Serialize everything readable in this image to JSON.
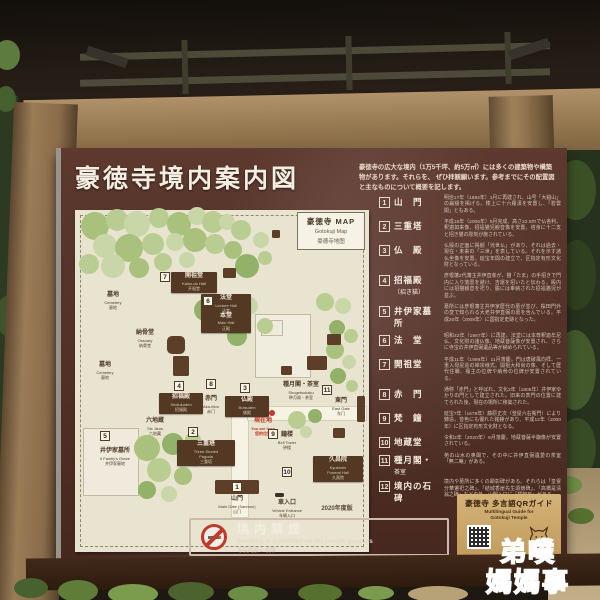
{
  "photo": {
    "watermark": {
      "line1": "弟噗",
      "line2": "媽媽事"
    }
  },
  "sign": {
    "title": "豪徳寺境内案内図",
    "intro": {
      "line1": "豪徳寺の広大な境内（1万5千坪、約5万㎡）には多くの建築物や構築物があります。それらを、",
      "line2": "ぜひ拝観願います。参考までにその配置図と主なものについて概要を記します。"
    },
    "map": {
      "corner_box": {
        "jp": "豪徳寺 MAP",
        "en": "Gotokuji Map",
        "zh": "豪德寺地图"
      },
      "tree_colors": [
        "#a9c17d",
        "#b9cd92",
        "#c8d6a8",
        "#93b168",
        "#d2dcb9"
      ],
      "trees": [
        {
          "x": 20,
          "y": 16,
          "r": 14,
          "c": 0
        },
        {
          "x": 42,
          "y": 10,
          "r": 11,
          "c": 1
        },
        {
          "x": 62,
          "y": 14,
          "r": 13,
          "c": 2
        },
        {
          "x": 84,
          "y": 8,
          "r": 10,
          "c": 1
        },
        {
          "x": 104,
          "y": 14,
          "r": 12,
          "c": 0
        },
        {
          "x": 122,
          "y": 6,
          "r": 9,
          "c": 2
        },
        {
          "x": 138,
          "y": 12,
          "r": 11,
          "c": 1
        },
        {
          "x": 30,
          "y": 36,
          "r": 12,
          "c": 2
        },
        {
          "x": 54,
          "y": 38,
          "r": 14,
          "c": 0
        },
        {
          "x": 78,
          "y": 34,
          "r": 11,
          "c": 1
        },
        {
          "x": 100,
          "y": 32,
          "r": 9,
          "c": 2
        },
        {
          "x": 120,
          "y": 30,
          "r": 12,
          "c": 0
        },
        {
          "x": 140,
          "y": 34,
          "r": 10,
          "c": 1
        },
        {
          "x": 14,
          "y": 54,
          "r": 10,
          "c": 1
        },
        {
          "x": 38,
          "y": 56,
          "r": 12,
          "c": 2
        },
        {
          "x": 64,
          "y": 58,
          "r": 10,
          "c": 0
        },
        {
          "x": 88,
          "y": 52,
          "r": 9,
          "c": 1
        },
        {
          "x": 112,
          "y": 50,
          "r": 8,
          "c": 2
        },
        {
          "x": 152,
          "y": 12,
          "r": 8,
          "c": 2
        },
        {
          "x": 166,
          "y": 20,
          "r": 10,
          "c": 1
        },
        {
          "x": 158,
          "y": 40,
          "r": 9,
          "c": 0
        },
        {
          "x": 172,
          "y": 56,
          "r": 12,
          "c": 3
        },
        {
          "x": 186,
          "y": 30,
          "r": 8,
          "c": 2
        },
        {
          "x": 190,
          "y": 48,
          "r": 7,
          "c": 1
        },
        {
          "x": 130,
          "y": 100,
          "r": 11,
          "c": 3
        },
        {
          "x": 152,
          "y": 108,
          "r": 14,
          "c": 0
        },
        {
          "x": 174,
          "y": 96,
          "r": 9,
          "c": 2
        },
        {
          "x": 190,
          "y": 116,
          "r": 8,
          "c": 1
        },
        {
          "x": 162,
          "y": 126,
          "r": 10,
          "c": 3
        },
        {
          "x": 250,
          "y": 92,
          "r": 9,
          "c": 1
        },
        {
          "x": 268,
          "y": 96,
          "r": 8,
          "c": 2
        },
        {
          "x": 262,
          "y": 118,
          "r": 8,
          "c": 3
        },
        {
          "x": 276,
          "y": 126,
          "r": 7,
          "c": 1
        },
        {
          "x": 260,
          "y": 140,
          "r": 9,
          "c": 0
        },
        {
          "x": 274,
          "y": 152,
          "r": 7,
          "c": 2
        },
        {
          "x": 263,
          "y": 166,
          "r": 8,
          "c": 3
        },
        {
          "x": 277,
          "y": 176,
          "r": 6,
          "c": 1
        },
        {
          "x": 72,
          "y": 238,
          "r": 13,
          "c": 0
        },
        {
          "x": 98,
          "y": 234,
          "r": 11,
          "c": 3
        },
        {
          "x": 118,
          "y": 230,
          "r": 8,
          "c": 1
        },
        {
          "x": 120,
          "y": 248,
          "r": 9,
          "c": 2
        },
        {
          "x": 84,
          "y": 260,
          "r": 12,
          "c": 1
        },
        {
          "x": 108,
          "y": 266,
          "r": 9,
          "c": 0
        },
        {
          "x": 72,
          "y": 280,
          "r": 9,
          "c": 3
        },
        {
          "x": 94,
          "y": 284,
          "r": 8,
          "c": 2
        },
        {
          "x": 222,
          "y": 210,
          "r": 9,
          "c": 1
        },
        {
          "x": 240,
          "y": 206,
          "r": 7,
          "c": 3
        },
        {
          "x": 231,
          "y": 222,
          "r": 6,
          "c": 2
        }
      ],
      "structures": [
        {
          "x": 140,
          "y": 270,
          "w": 44,
          "h": 14
        },
        {
          "x": 92,
          "y": 126,
          "w": 18,
          "h": 18,
          "oct": 1
        },
        {
          "x": 98,
          "y": 146,
          "w": 16,
          "h": 20
        },
        {
          "x": 282,
          "y": 186,
          "w": 8,
          "h": 26
        },
        {
          "x": 232,
          "y": 146,
          "w": 20,
          "h": 14
        },
        {
          "x": 252,
          "y": 124,
          "w": 14,
          "h": 11
        },
        {
          "x": 206,
          "y": 156,
          "w": 11,
          "h": 9
        },
        {
          "x": 148,
          "y": 58,
          "w": 13,
          "h": 10
        },
        {
          "x": 197,
          "y": 20,
          "w": 8,
          "h": 8
        },
        {
          "x": 258,
          "y": 218,
          "w": 12,
          "h": 10
        }
      ],
      "labels": [
        {
          "type": "box",
          "x": 96,
          "y": 62,
          "w": 44,
          "lines": [
            "jp|開祖堂",
            "en|Kaiso-do Hall",
            "zh|开祖堂"
          ]
        },
        {
          "type": "box",
          "x": 126,
          "y": 84,
          "w": 48,
          "lines": [
            "jp|法堂",
            "en|Lecture Hall",
            "zh|法堂",
            "jp|本堂",
            "en|Main Hall",
            "zh|正殿"
          ]
        },
        {
          "type": "box",
          "x": 84,
          "y": 183,
          "w": 42,
          "lines": [
            "jp|招福殿",
            "en|Shofukuden",
            "zh|招福殿"
          ]
        },
        {
          "type": "box",
          "x": 150,
          "y": 186,
          "w": 42,
          "lines": [
            "jp|仏殿",
            "en|Butsuden",
            "zh|佛殿"
          ]
        },
        {
          "type": "box",
          "x": 102,
          "y": 230,
          "w": 56,
          "lines": [
            "jp|三重塔",
            "en|Three-Storied",
            "en|Pagoda",
            "zh|三重塔"
          ]
        },
        {
          "type": "box",
          "x": 238,
          "y": 246,
          "w": 48,
          "lines": [
            "jp|久昌院",
            "en|Kyushoin",
            "en|Funeral Hall",
            "zh|久昌院"
          ]
        },
        {
          "type": "text",
          "x": 38,
          "y": 82,
          "lines": [
            "jp|墓地",
            "en|Cemetery",
            "zh|墓地"
          ]
        },
        {
          "type": "text",
          "x": 70,
          "y": 120,
          "lines": [
            "jp|納骨堂",
            "en|Ossuary",
            "zh|纳骨堂"
          ]
        },
        {
          "type": "text",
          "x": 30,
          "y": 152,
          "lines": [
            "jp|墓地",
            "en|Cemetery",
            "zh|墓地"
          ]
        },
        {
          "type": "text",
          "x": 80,
          "y": 208,
          "lines": [
            "jp|六地蔵",
            "en|Six Jizos",
            "zh|六地藏"
          ]
        },
        {
          "type": "text",
          "x": 40,
          "y": 238,
          "lines": [
            "jp|井伊家墓所",
            "en|Ii Family's Grave",
            "zh|井伊家墓地"
          ]
        },
        {
          "type": "text",
          "x": 136,
          "y": 186,
          "lines": [
            "jp|赤門",
            "en|Aka-Mon",
            "zh|赤门"
          ]
        },
        {
          "type": "text",
          "x": 212,
          "y": 222,
          "lines": [
            "jp|鐘楼",
            "en|Bell Tower",
            "zh|钟楼"
          ]
        },
        {
          "type": "text",
          "x": 226,
          "y": 172,
          "lines": [
            "jp|種月閣・茶室",
            "en|Shugetsukaku",
            "zh|种月阁・茶室"
          ]
        },
        {
          "type": "text",
          "x": 266,
          "y": 188,
          "lines": [
            "jp|東門",
            "en|East Gate",
            "zh|东门"
          ]
        },
        {
          "type": "text",
          "x": 162,
          "y": 286,
          "lines": [
            "jp|山門",
            "en|Main Gate (Sanmon)",
            "zh|山门"
          ]
        },
        {
          "type": "text",
          "x": 212,
          "y": 290,
          "lines": [
            "jp|車入口",
            "en|Vehicle Entrance",
            "zh|车辆入口"
          ]
        },
        {
          "type": "red",
          "x": 188,
          "y": 208,
          "lines": [
            "jp|現在地",
            "en|You are here",
            "zh|您的位置"
          ]
        },
        {
          "type": "note",
          "x": 262,
          "y": 296,
          "lines": [
            "jp|2020年度版"
          ]
        }
      ],
      "markers": [
        {
          "n": "7",
          "x": 90,
          "y": 67
        },
        {
          "n": "6",
          "x": 133,
          "y": 91
        },
        {
          "n": "4",
          "x": 104,
          "y": 176
        },
        {
          "n": "8",
          "x": 136,
          "y": 174
        },
        {
          "n": "3",
          "x": 170,
          "y": 178
        },
        {
          "n": "2",
          "x": 118,
          "y": 222
        },
        {
          "n": "5",
          "x": 30,
          "y": 226
        },
        {
          "n": "9",
          "x": 198,
          "y": 224
        },
        {
          "n": "11",
          "x": 252,
          "y": 180
        },
        {
          "n": "10",
          "x": 212,
          "y": 262
        },
        {
          "n": "1",
          "x": 162,
          "y": 277
        }
      ]
    },
    "legend": {
      "items": [
        {
          "num": "1",
          "name": "山　門",
          "sub": "",
          "desc": "明治17年（1884年）1月に再建され、山号「大谿山」の扁額を掲げる。楼上に十六羅漢を安置し、「碧雲関」ともある。"
        },
        {
          "num": "2",
          "name": "三重塔",
          "sub": "",
          "desc": "平成18年（2006年）5月完成、高さ22.5ｍで仏舎利、釈迦如来像、招福猫児観音像を安置。塔身に十二支と招き猫の彫刻が施されている。"
        },
        {
          "num": "3",
          "name": "仏　殿",
          "sub": "",
          "desc": "仏殿の正面に掲額「弐世仏」があり、それは過去・現在・未来の「三世」を表している。それを示す諸仏坐像を安置。延宝年間の建立で、区指定有形文化財となっている。"
        },
        {
          "num": "4",
          "name": "招福殿",
          "sub": "〔招き猫〕",
          "desc": "彦根藩2代藩主井伊直孝が、猫「たま」の手招きで門内に入り落雷を避け、吉運を招いたと伝わる。殿内には招猫観音を祀り、脇には奉納された招福猫児が並ぶ。"
        },
        {
          "num": "5",
          "name": "井伊家墓所",
          "sub": "",
          "desc": "墓所には彦根藩主井伊家歴代の墓が並び、桜田門外の変で知られる大老井伊直弼の墓を含んでいる。平成20年（2008年）に国指定史跡となった。"
        },
        {
          "num": "6",
          "name": "法　堂",
          "sub": "",
          "desc": "昭和42年（1967年）に再建。法堂には本尊釈迦牟尼仏、文化財の諸仏像、地蔵菩薩像が安置され、さらに寺宝の井伊直弼遺品等が納められている。"
        },
        {
          "num": "7",
          "name": "開祖堂",
          "sub": "",
          "desc": "平成11年（1999年）11月落慶。門は唐破風向拝、一重入母屋造の禅宗様式。開祖大和尚の像、そして歴代住職、檀主の位牌や納骨の位牌が安置されている。"
        },
        {
          "num": "8",
          "name": "赤　門",
          "sub": "",
          "desc": "通称「赤門」と呼ばれ、文化2年（1805年）井伊家ゆかりの門として建立された。旧来の表門の位置に建てられた後、現在の場所に移築された。"
        },
        {
          "num": "9",
          "name": "梵　鐘",
          "sub": "",
          "desc": "延宝7年（1679年）藤原正次（釜屋六右衛門）により鋳造。音色にも優れた銘鐘があり、平成12年（2000年）に区指定有形文化財となる。"
        },
        {
          "num": "10",
          "name": "地蔵堂",
          "sub": "",
          "desc": "令和2年（2020年）9月落慶。地蔵菩薩半跏像が安置されている。"
        },
        {
          "num": "11",
          "name": "種月閣・",
          "sub": "茶室",
          "desc": "苑の山水の奥閣で、その中に井伊直弼遺愛の茶室「無二庵」がある。"
        },
        {
          "num": "12",
          "name": "境内の石碑",
          "sub": "",
          "desc": "境内や墓所に多くの顕彰碑がある。それらは「皇霊分華遷祀之碑」、「結城香崖先生頌徳碑」、「高橋是清翁之碑」などの外、山門入口に「標榜石」がある。"
        }
      ]
    },
    "no_smoking": {
      "jp": "境内禁煙",
      "en": "Smoking is prohibited on the temple grounds",
      "zh": "寺院内禁止吸烟"
    },
    "qr_guide": {
      "jp": "豪徳寺 多言語QRガイド",
      "en1": "Multilingual Guide for",
      "en2": "Gotokuji Temple"
    }
  }
}
